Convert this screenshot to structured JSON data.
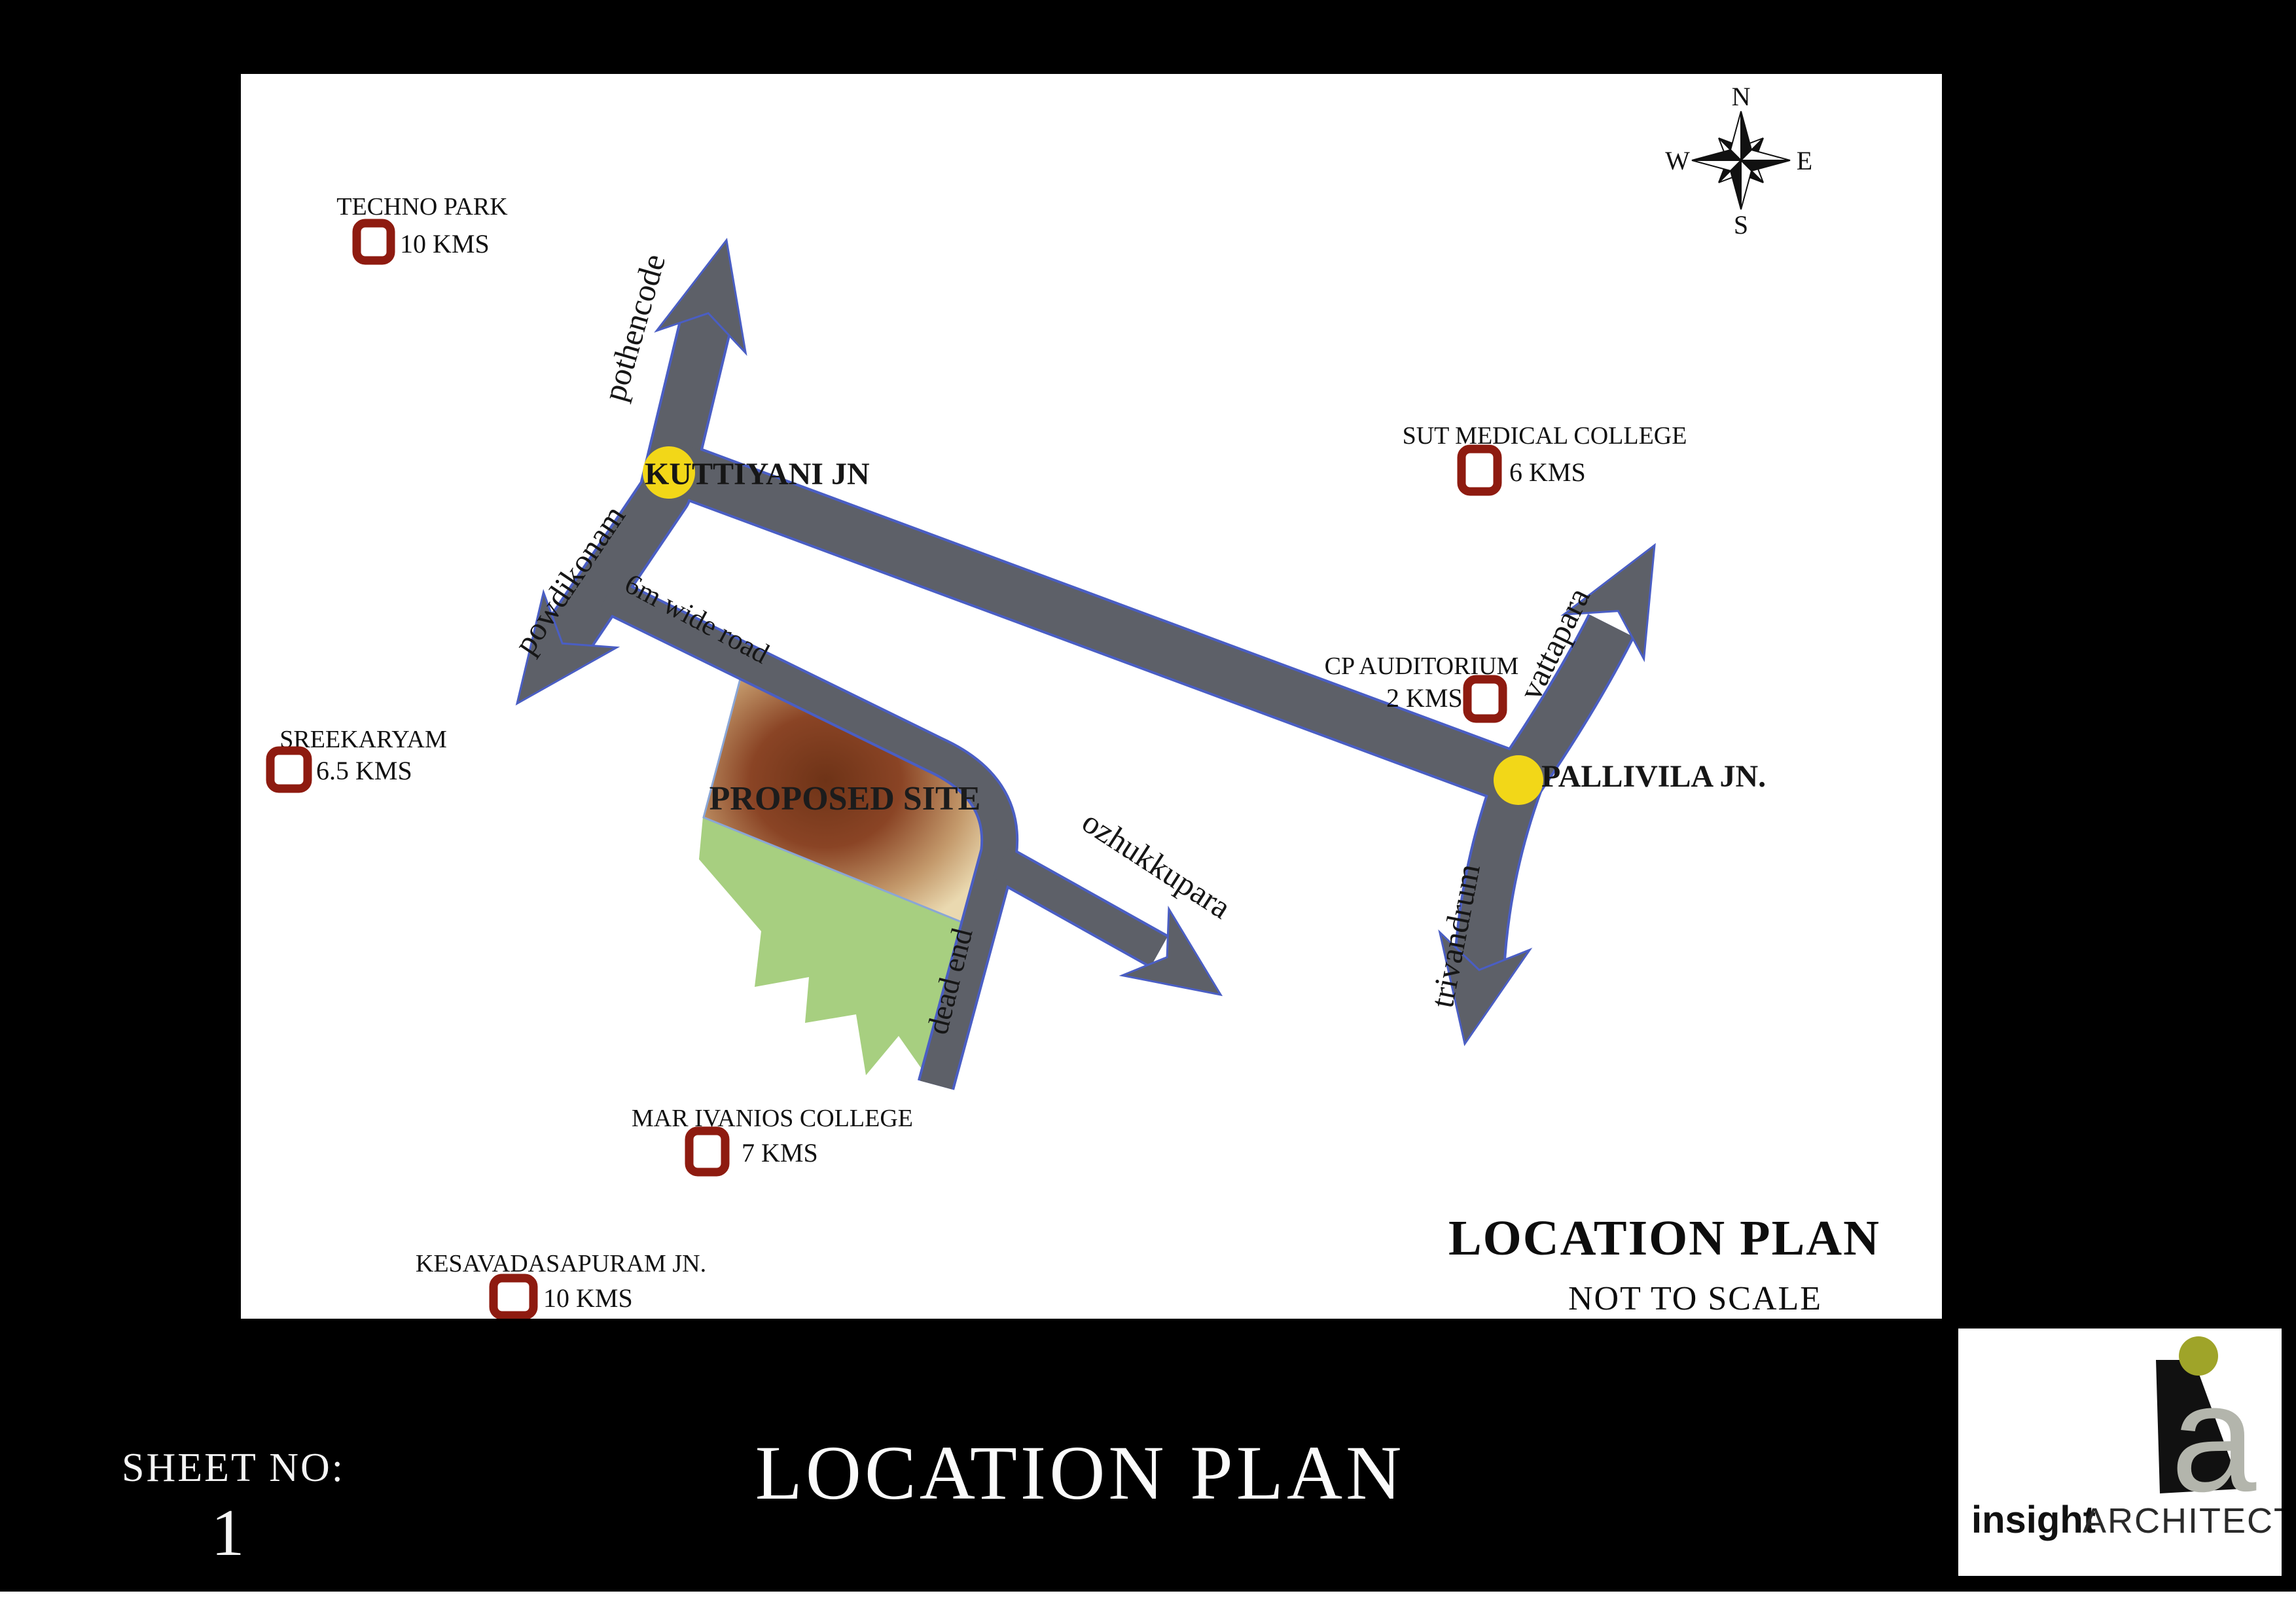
{
  "map": {
    "compass": {
      "n": "N",
      "e": "E",
      "s": "S",
      "w": "W"
    },
    "roads": {
      "pothencode": "pothencode",
      "powdikonam": "powdikonam",
      "six_m_wide": "6m wide road",
      "dead_end": "dead end",
      "ozhukkupara": "ozhukkupara",
      "vattapara": "vattapara",
      "trivandrum": "trivandrum"
    },
    "junctions": {
      "kuttiyani": "KUTTIYANI JN",
      "pallivila": "PALLIVILA JN."
    },
    "site_label": "PROPOSED SITE",
    "landmarks": [
      {
        "name": "TECHNO PARK",
        "distance": "10 KMS"
      },
      {
        "name": "SUT MEDICAL COLLEGE",
        "distance": "6 KMS"
      },
      {
        "name": "CP AUDITORIUM",
        "distance": "2 KMS"
      },
      {
        "name": "SREEKARYAM",
        "distance": "6.5 KMS"
      },
      {
        "name": "MAR IVANIOS COLLEGE",
        "distance": "7 KMS"
      },
      {
        "name": "KESAVADASAPURAM JN.",
        "distance": "10 KMS"
      }
    ],
    "title": "LOCATION PLAN",
    "scale_note": "NOT TO SCALE"
  },
  "titleblock": {
    "sheet_label": "SHEET NO:",
    "sheet_number": "1",
    "drawing_title": "LOCATION PLAN",
    "firm": {
      "logo_letter": "a",
      "name_primary": "insight",
      "name_secondary": "ARCHITECTS"
    }
  },
  "colors": {
    "road_fill": "#5d6068",
    "road_outline": "#4a5ec4",
    "junction_yellow": "#f2d718",
    "landmark_red": "#8e1b10",
    "site_green": "#a7cf80",
    "site_tan": "#ead9b0",
    "site_brown": "#6e3317",
    "logo_olive": "#9fa429",
    "logo_gray": "#b3b5ac"
  }
}
